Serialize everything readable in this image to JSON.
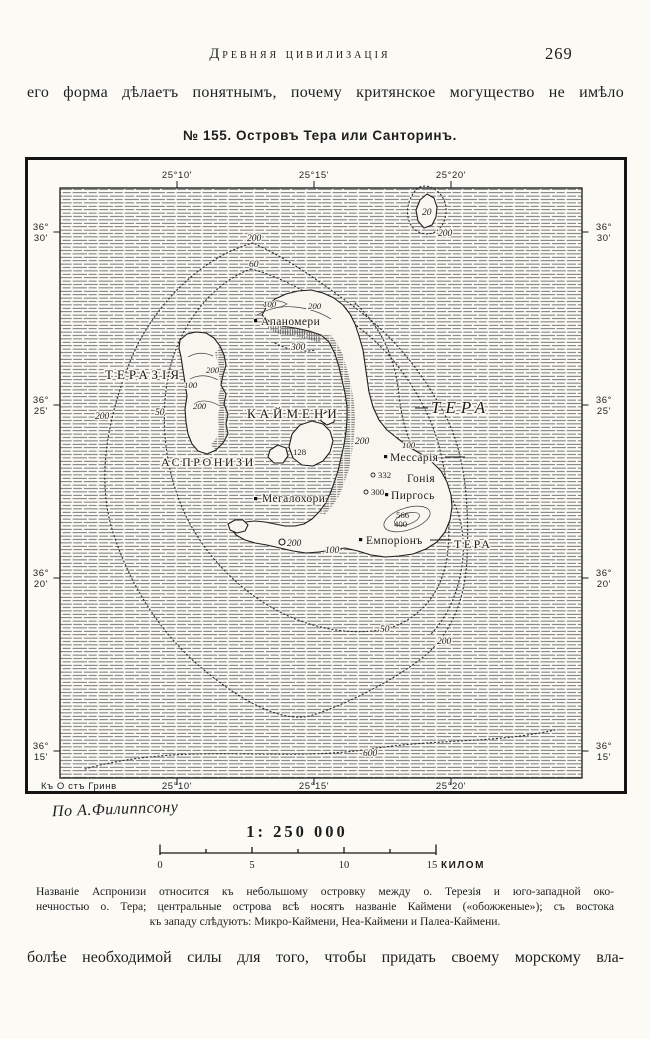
{
  "page": {
    "running_head": "Древняя цивилизація",
    "page_number": "269",
    "intro_line": "его форма дѣлаетъ понятнымъ, почему критянское могущество не имѣло",
    "figure_title": "№ 155. Островъ Тера или Санторинъ.",
    "closing_line": "болѣе необходимой силы для того, чтобы придать своему морскому вла-"
  },
  "map": {
    "attribution": "По А.Филиппсону",
    "scale": {
      "ratio": "1: 250 000",
      "ticks": [
        "0",
        "5",
        "10",
        "15"
      ],
      "unit": "КИЛОМ"
    },
    "graticule": {
      "top": [
        "25°10'",
        "25°15'",
        "25°20'"
      ],
      "bottom": [
        "25°10'",
        "25°15'",
        "25°20'"
      ],
      "bottom_note": "Къ О стъ Гринв",
      "left": [
        {
          "deg": "36°",
          "min": "30'"
        },
        {
          "deg": "36°",
          "min": "25'"
        },
        {
          "deg": "36°",
          "min": "20'"
        },
        {
          "deg": "36°",
          "min": "15'"
        }
      ],
      "right": [
        {
          "deg": "36°",
          "min": "30'"
        },
        {
          "deg": "36°",
          "min": "25'"
        },
        {
          "deg": "36°",
          "min": "20'"
        },
        {
          "deg": "36°",
          "min": "15'"
        }
      ]
    },
    "regions": [
      "ТЕРАЗІЯ",
      "КАЙМЕНИ",
      "АСПРОНИЗИ",
      "ТЕРА",
      "ТЕРА"
    ],
    "towns": [
      "Апаномери",
      "Мессарія",
      "Гонія",
      "Пиргось",
      "Мегалохори",
      "Емпоріонъ"
    ],
    "sea_depths": [
      "200",
      "60",
      "20",
      "200",
      "200",
      "50",
      "300",
      "200",
      "200",
      "100",
      "50",
      "200",
      "600"
    ],
    "land_contours": [
      "100",
      "200",
      "200",
      "100",
      "200",
      "100"
    ],
    "elevations": [
      "128",
      "332",
      "300",
      "566",
      "400"
    ]
  },
  "caption": {
    "line1": "Названіе Аспронизи относится къ небольшому островку между о. Терезія и юго-западной око-",
    "line2": "нечностью о. Тера; центральные острова всѣ носятъ названіе Каймени («обожженые»); съ востока",
    "line3": "къ западу слѣдуютъ: Микро-Каймени, Неа-Каймени и Палеа-Каймени."
  }
}
